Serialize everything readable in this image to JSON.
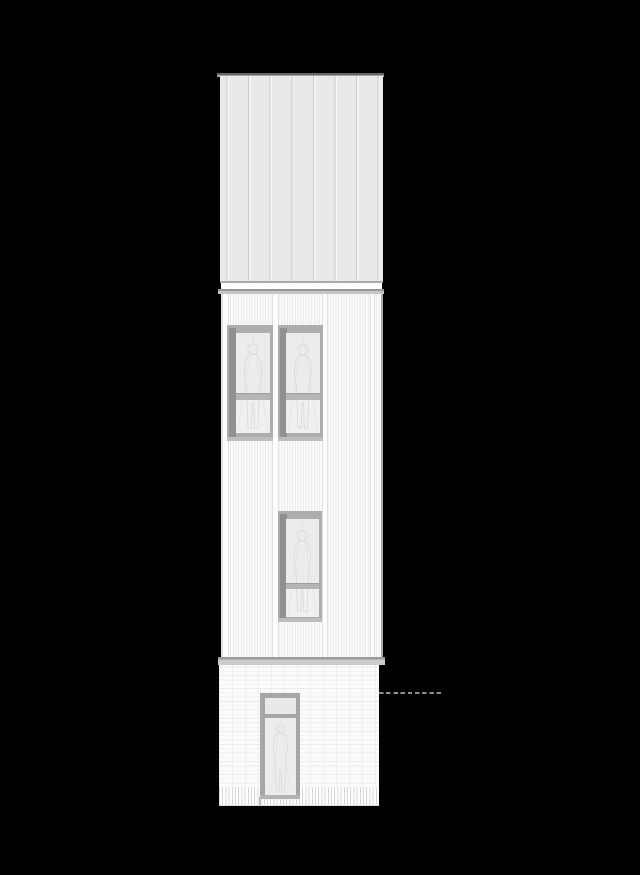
{
  "scene": {
    "title": "Building elevation drawing",
    "description": "Front elevation of a tall narrow three-storey building drawn in light grey linework on a black background",
    "background_color": "#000000",
    "drawing_line_color": "#d9d9d9"
  },
  "building": {
    "roof": {
      "name": "Standing-seam clad upper volume",
      "cap_label": "roof cap flashing",
      "panel_fill": "#e9e9e9",
      "seam_color": "#c9c9c9",
      "cap_color": "#666666",
      "seam_count": 8
    },
    "eave": {
      "name": "Eave trim band",
      "color": "#989898"
    },
    "upper_wall": {
      "name": "Vertical corrugated siding wall",
      "fill": "#f8f8f8",
      "batten_count": 4,
      "windows": [
        {
          "name": "upper-left window",
          "panes": 2,
          "frame_color": "#adadad",
          "glass_color": "#ececec",
          "has_scale_figure": true
        },
        {
          "name": "upper-right window",
          "panes": 2,
          "frame_color": "#adadad",
          "glass_color": "#ececec",
          "has_scale_figure": true
        },
        {
          "name": "mid-level window",
          "panes": 2,
          "frame_color": "#adadad",
          "glass_color": "#ececec",
          "has_scale_figure": true
        }
      ]
    },
    "ground_floor": {
      "name": "Brick ground floor",
      "fill": "#fcfcfc",
      "course_line_color": "#ececec",
      "soldier_course": "vertical hatched base band",
      "door": {
        "name": "entry door with transom light",
        "frame_color": "#a6a6a6",
        "glass_color": "#ececec",
        "has_scale_figure": true
      }
    },
    "datum": {
      "name": "floor level datum dashed line",
      "color": "#8f8f8f",
      "style": "dashed"
    }
  }
}
